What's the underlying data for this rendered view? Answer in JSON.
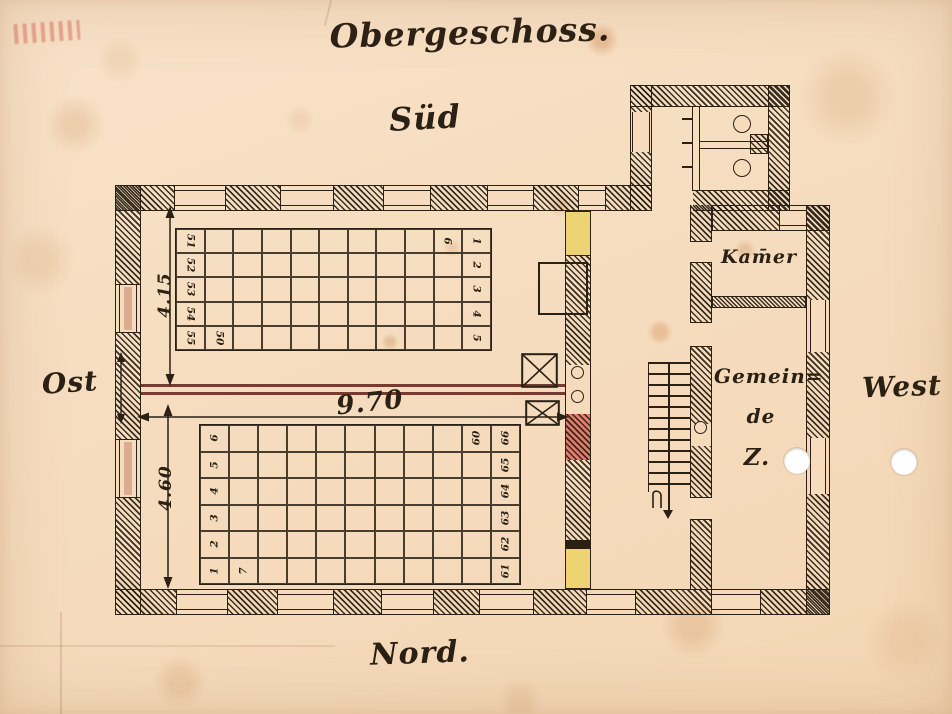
{
  "document": {
    "title": "Obergeschoss."
  },
  "compass": {
    "south": "Süd",
    "north": "Nord.",
    "east": "Ost",
    "west": "West"
  },
  "rooms": {
    "kammer": "Kam̄er",
    "gemeinde_line1": "Gemein=",
    "gemeinde_line2": "de",
    "gemeinde_line3": "Z."
  },
  "dimensions": {
    "upper_hall_depth": "4.15",
    "lower_hall_depth": "4.60",
    "hall_width": "9.70"
  },
  "seating": {
    "upper": {
      "rows": 5,
      "cols": 11,
      "rotation": 90,
      "cells": [
        {
          "r": 0,
          "c": 10,
          "t": "1"
        },
        {
          "r": 1,
          "c": 10,
          "t": "2"
        },
        {
          "r": 2,
          "c": 10,
          "t": "3"
        },
        {
          "r": 3,
          "c": 10,
          "t": "4"
        },
        {
          "r": 4,
          "c": 10,
          "t": "5"
        },
        {
          "r": 0,
          "c": 9,
          "t": "6"
        },
        {
          "r": 4,
          "c": 1,
          "t": "50"
        },
        {
          "r": 0,
          "c": 0,
          "t": "51"
        },
        {
          "r": 1,
          "c": 0,
          "t": "52"
        },
        {
          "r": 2,
          "c": 0,
          "t": "53"
        },
        {
          "r": 3,
          "c": 0,
          "t": "54"
        },
        {
          "r": 4,
          "c": 0,
          "t": "55"
        }
      ]
    },
    "lower": {
      "rows": 6,
      "cols": 11,
      "rotation": -90,
      "cells": [
        {
          "r": 5,
          "c": 0,
          "t": "1"
        },
        {
          "r": 4,
          "c": 0,
          "t": "2"
        },
        {
          "r": 3,
          "c": 0,
          "t": "3"
        },
        {
          "r": 2,
          "c": 0,
          "t": "4"
        },
        {
          "r": 1,
          "c": 0,
          "t": "5"
        },
        {
          "r": 0,
          "c": 0,
          "t": "6"
        },
        {
          "r": 5,
          "c": 1,
          "t": "7"
        },
        {
          "r": 0,
          "c": 9,
          "t": "60"
        },
        {
          "r": 5,
          "c": 10,
          "t": "61"
        },
        {
          "r": 4,
          "c": 10,
          "t": "62"
        },
        {
          "r": 3,
          "c": 10,
          "t": "63"
        },
        {
          "r": 2,
          "c": 10,
          "t": "64"
        },
        {
          "r": 1,
          "c": 10,
          "t": "65"
        },
        {
          "r": 0,
          "c": 10,
          "t": "66"
        }
      ]
    }
  },
  "colors": {
    "paper": "#f6dcbd",
    "ink": "#2a2014",
    "parapet_red": "#7b3a31",
    "wall_marking_red": "#e0645a",
    "wall_marking_yellow": "#eed372",
    "window_tint_red": "#c9826f"
  }
}
